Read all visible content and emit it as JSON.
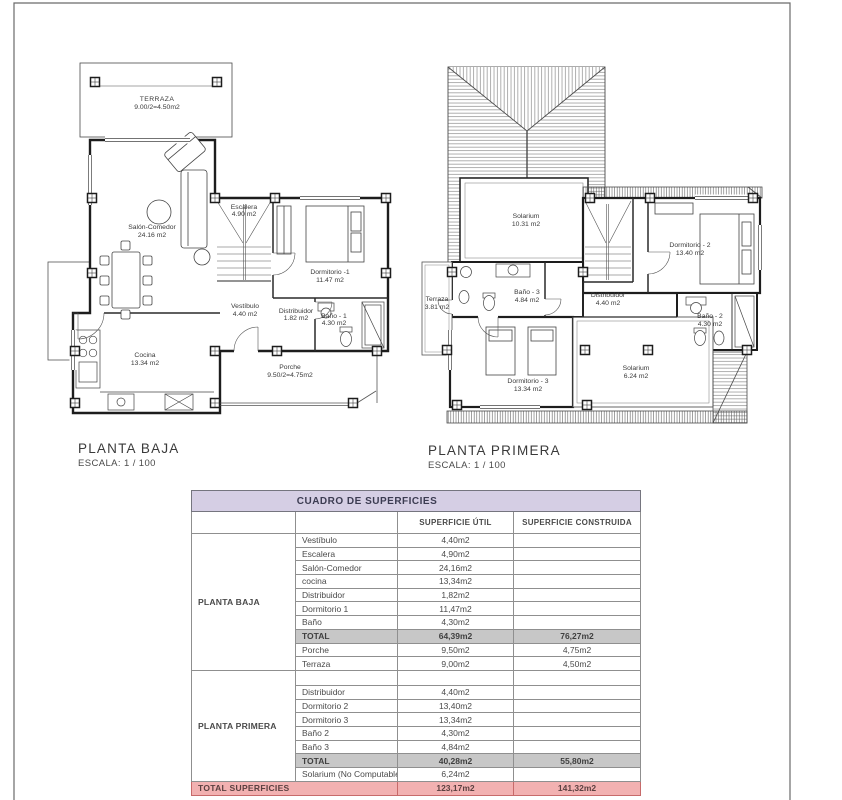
{
  "sheet": {
    "plan1": {
      "title": "PLANTA BAJA",
      "scale": "ESCALA: 1 / 100",
      "rooms": {
        "terraza": {
          "name": "TERRAZA",
          "area": "9.00/2=4.50m2"
        },
        "salon": {
          "name": "Salón-Comedor",
          "area": "24.16 m2"
        },
        "escalera": {
          "name": "Escalera",
          "area": "4.90 m2"
        },
        "dormitorio1": {
          "name": "Dormitorio -1",
          "area": "11.47 m2"
        },
        "vestibulo": {
          "name": "Vestíbulo",
          "area": "4.40 m2"
        },
        "distribuidor": {
          "name": "Distribuidor",
          "area": "1.82 m2"
        },
        "bano": {
          "name": "Baño - 1",
          "area": "4.30 m2"
        },
        "cocina": {
          "name": "Cocina",
          "area": "13.34 m2"
        },
        "porche": {
          "name": "Porche",
          "area": "9.50/2=4.75m2"
        }
      }
    },
    "plan2": {
      "title": "PLANTA PRIMERA",
      "scale": "ESCALA: 1 / 100",
      "rooms": {
        "solarium1": {
          "name": "Solarium",
          "area": "10.31 m2"
        },
        "dormitorio2": {
          "name": "Dormitorio - 2",
          "area": "13.40 m2"
        },
        "terraza": {
          "name": "Terraza",
          "area": "3.81 m2"
        },
        "bano3": {
          "name": "Baño - 3",
          "area": "4.84 m2"
        },
        "distribuidor": {
          "name": "Distribuidor",
          "area": "4.40 m2"
        },
        "bano2": {
          "name": "Baño - 2",
          "area": "4.30 m2"
        },
        "dormitorio3": {
          "name": "Dormitorio - 3",
          "area": "13.34 m2"
        },
        "solarium2": {
          "name": "Solarium",
          "area": "6.24 m2"
        }
      }
    }
  },
  "table": {
    "title": "CUADRO DE SUPERFICIES",
    "col_util": "SUPERFICIE ÚTIL",
    "col_construida": "SUPERFICIE CONSTRUIDA",
    "colors": {
      "header_bg": "#d5cee4",
      "total_bg": "#c7c7c7",
      "grand_bg": "#f2b1b1"
    },
    "sections": [
      {
        "group": "PLANTA BAJA",
        "rows": [
          {
            "name": "Vestíbulo",
            "util": "4,40m2",
            "construida": ""
          },
          {
            "name": "Escalera",
            "util": "4,90m2",
            "construida": ""
          },
          {
            "name": "Salón-Comedor",
            "util": "24,16m2",
            "construida": ""
          },
          {
            "name": "cocina",
            "util": "13,34m2",
            "construida": ""
          },
          {
            "name": "Distribuidor",
            "util": "1,82m2",
            "construida": ""
          },
          {
            "name": "Dormitorio 1",
            "util": "11,47m2",
            "construida": ""
          },
          {
            "name": "Baño",
            "util": "4,30m2",
            "construida": ""
          },
          {
            "name": "TOTAL",
            "util": "64,39m2",
            "construida": "76,27m2",
            "total": true
          },
          {
            "name": "Porche",
            "util": "9,50m2",
            "construida": "4,75m2"
          },
          {
            "name": "Terraza",
            "util": "9,00m2",
            "construida": "4,50m2"
          }
        ]
      },
      {
        "group": "PLANTA PRIMERA",
        "rows": [
          {
            "name": "",
            "util": "",
            "construida": "",
            "spacer": true
          },
          {
            "name": "Distribuidor",
            "util": "4,40m2",
            "construida": ""
          },
          {
            "name": "Dormitorio 2",
            "util": "13,40m2",
            "construida": ""
          },
          {
            "name": "Dormitorio 3",
            "util": "13,34m2",
            "construida": ""
          },
          {
            "name": "Baño 2",
            "util": "4,30m2",
            "construida": ""
          },
          {
            "name": "Baño 3",
            "util": "4,84m2",
            "construida": ""
          },
          {
            "name": "TOTAL",
            "util": "40,28m2",
            "construida": "55,80m2",
            "total": true
          },
          {
            "name": "Solarium (No Computable)",
            "util": "6,24m2",
            "construida": ""
          }
        ]
      }
    ],
    "grand_total": {
      "label": "TOTAL SUPERFICIES",
      "util": "123,17m2",
      "construida": "141,32m2"
    }
  }
}
